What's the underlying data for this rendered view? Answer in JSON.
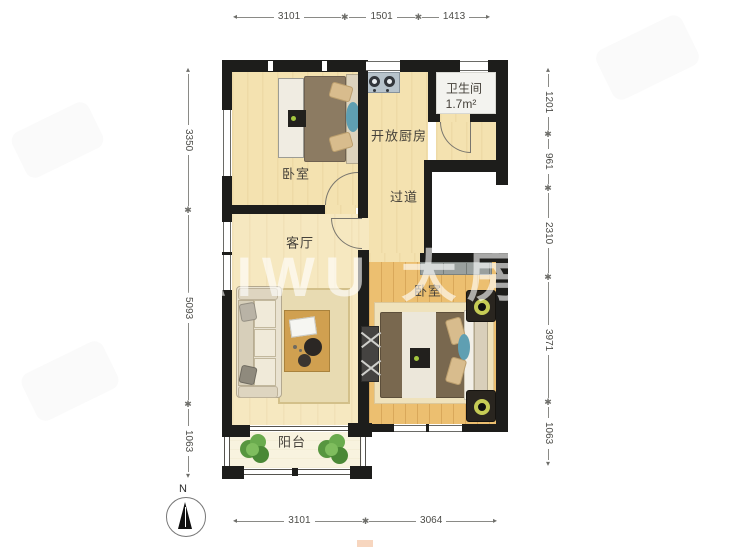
{
  "watermark": {
    "text": "AIWU 大房"
  },
  "compass": {
    "label": "N"
  },
  "rooms": {
    "bedroom_top": {
      "label": "卧室"
    },
    "kitchen": {
      "label": "开放厨房"
    },
    "bathroom": {
      "label": "卫生间",
      "area": "1.7m²"
    },
    "hallway": {
      "label": "过道"
    },
    "living_room": {
      "label": "客厅"
    },
    "bedroom_right": {
      "label": "卧室"
    },
    "balcony": {
      "label": "阳台"
    }
  },
  "dimensions": {
    "top": [
      "3101",
      "1501",
      "1413"
    ],
    "bottom": [
      "3101",
      "3064"
    ],
    "left": [
      "3350",
      "5093",
      "1063"
    ],
    "right": [
      "1201",
      "961",
      "2310",
      "3971",
      "1063"
    ]
  },
  "colors": {
    "wall": "#1d1d1b",
    "floor_cream": "#f4e2b0",
    "floor_wood": "#ecbf70",
    "floor_balcony": "#f8f3df",
    "accent_teal": "#5f9fb2"
  }
}
